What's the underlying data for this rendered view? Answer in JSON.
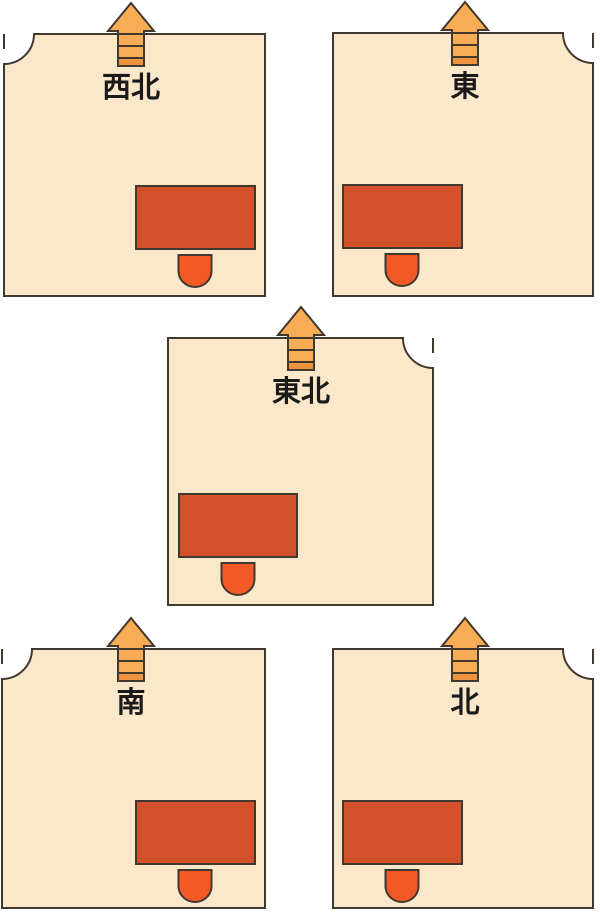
{
  "diagram": {
    "background": "#ffffff",
    "colors": {
      "room_fill": "#fbe7c9",
      "outline": "#413830",
      "arrow_fill": "#f8ac55",
      "arrow_band": "#ee9340",
      "desk_fill": "#d2512a",
      "chair_fill": "#f15a25",
      "label_color": "#1a1a1a"
    },
    "rooms": [
      {
        "label": "西北",
        "door_corner": "top-left",
        "desk_side": "right"
      },
      {
        "label": "東",
        "door_corner": "top-right",
        "desk_side": "left"
      },
      {
        "label": "東北",
        "door_corner": "top-right",
        "desk_side": "left"
      },
      {
        "label": "南",
        "door_corner": "top-left",
        "desk_side": "right"
      },
      {
        "label": "北",
        "door_corner": "top-right",
        "desk_side": "left"
      }
    ]
  }
}
